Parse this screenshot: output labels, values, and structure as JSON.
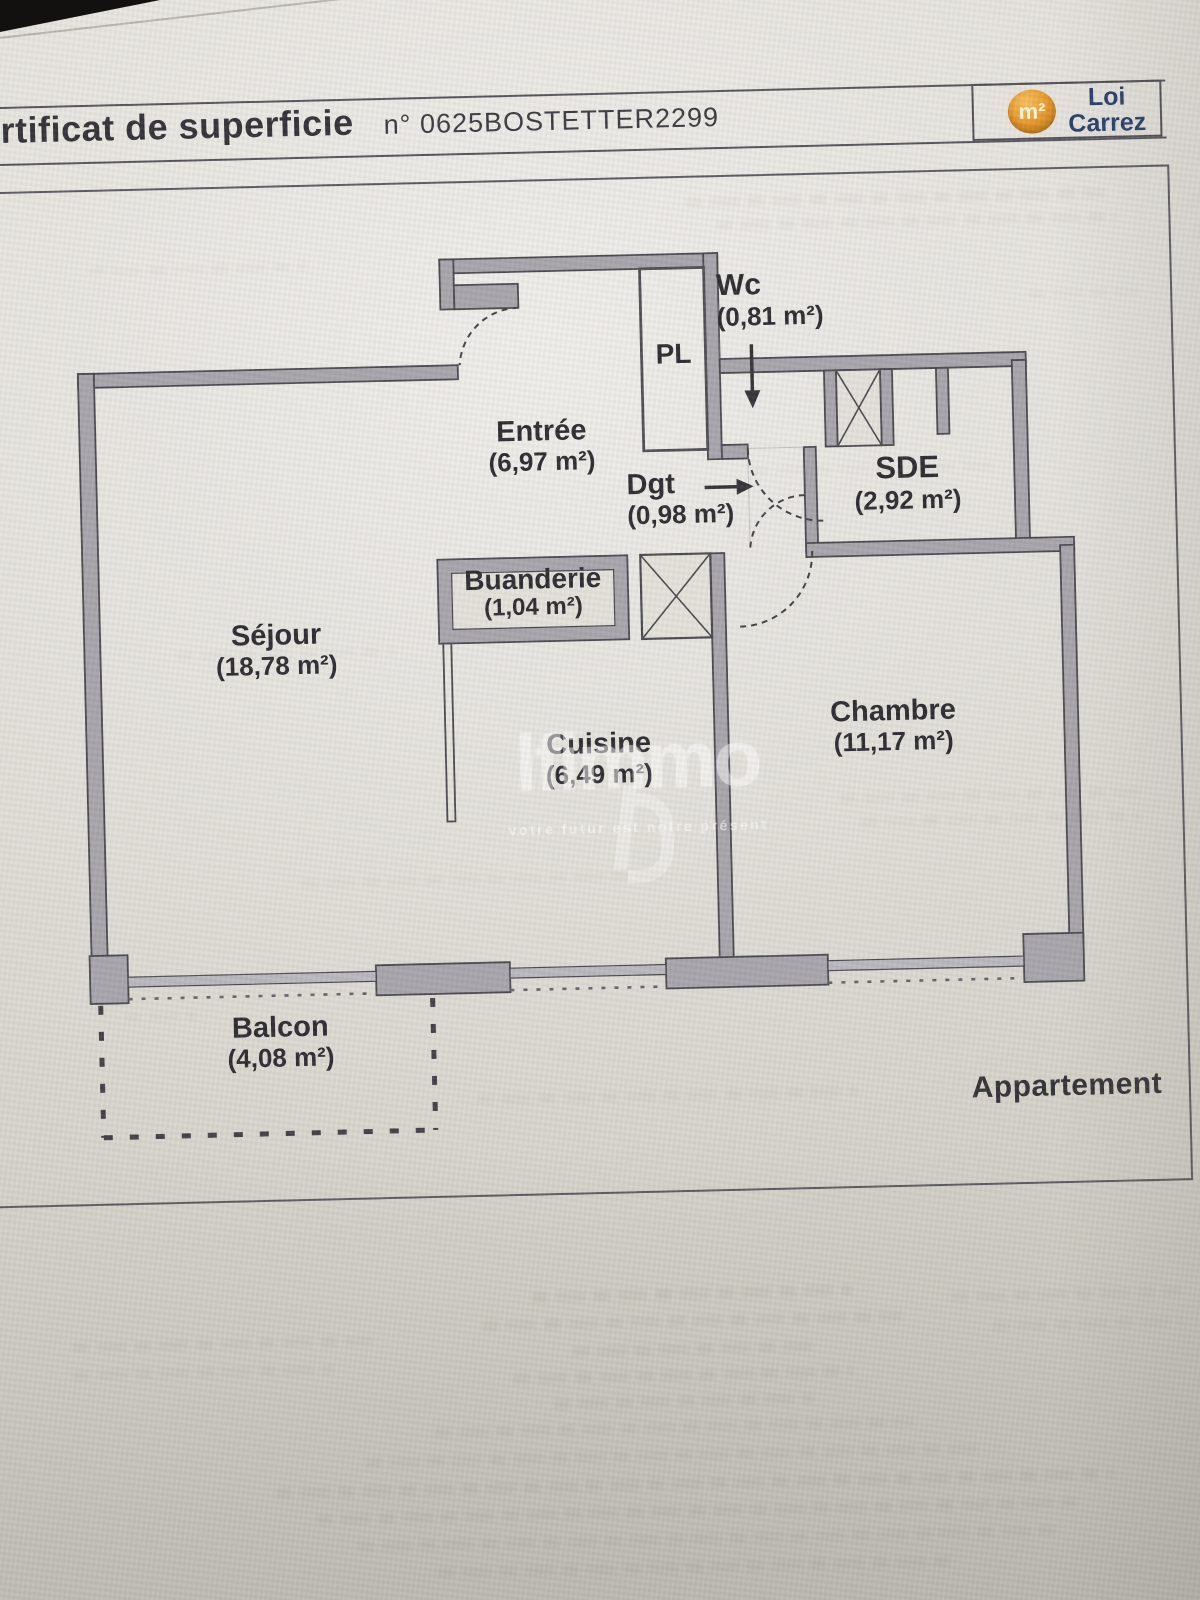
{
  "document": {
    "title_visible": "ertificat de superficie",
    "reference": "n° 0625BOSTETTER2299",
    "badge": {
      "symbol": "m²",
      "line1": "Loi",
      "line2": "Carrez"
    },
    "footer_label": "Appartement"
  },
  "rooms": {
    "wc": {
      "name": "Wc",
      "area": "(0,81 m²)"
    },
    "pl": {
      "name": "PL"
    },
    "entree": {
      "name": "Entrée",
      "area": "(6,97 m²)"
    },
    "dgt": {
      "name": "Dgt",
      "area": "(0,98 m²)"
    },
    "sde": {
      "name": "SDE",
      "area": "(2,92 m²)"
    },
    "buanderie": {
      "name": "Buanderie",
      "area": "(1,04 m²)"
    },
    "sejour": {
      "name": "Séjour",
      "area": "(18,78 m²)"
    },
    "cuisine": {
      "name": "Cuisine",
      "area": "(6,49 m²)"
    },
    "chambre": {
      "name": "Chambre",
      "area": "(11,17 m²)"
    },
    "balcon": {
      "name": "Balcon",
      "area": "(4,08 m²)"
    }
  },
  "watermark": {
    "brand": "lfimmo",
    "tagline": "votre futur est notre présent"
  },
  "colors": {
    "badge_orange": "#d9861a",
    "badge_navy": "#1f3864",
    "wall_gray": "#a5a2aa",
    "line_dark": "#45444a",
    "paper": "#d9d6cf"
  }
}
